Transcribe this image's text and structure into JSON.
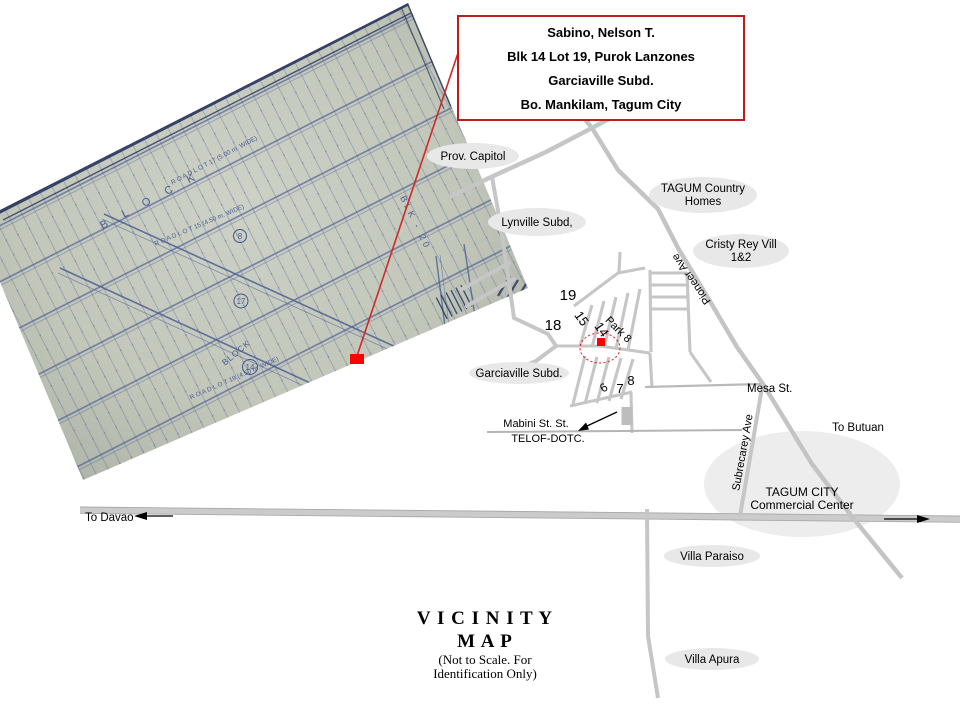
{
  "info_box": {
    "line1": "Sabino, Nelson T.",
    "line2": "Blk  14 Lot 19, Purok Lanzones",
    "line3": "Garciaville Subd.",
    "line4": "Bo. Mankilam, Tagum City"
  },
  "title_block": {
    "line1": "V I C I N I T Y",
    "line2": "M A P",
    "note1": "(Not to Scale. For",
    "note2": "Identification Only)"
  },
  "labels": {
    "prov_capitol": "Prov. Capitol",
    "lynville": "Lynville Subd,",
    "tagum_country_line1": "TAGUM Country",
    "tagum_country_line2": "Homes",
    "cristy_line1": "Cristy Rey Vill",
    "cristy_line2": "1&2",
    "garciaville": "Garciaville Subd.",
    "mesa_st": "Mesa St.",
    "to_butuan": "To Butuan",
    "to_davao": "To Davao",
    "mabini_st": "Mabini St. St.",
    "telof_dotc": "TELOF-DOTC.",
    "commercial_line1": "TAGUM CITY",
    "commercial_line2": "Commercial Center",
    "villa_paraiso": "Villa Paraiso",
    "villa_apura": "Villa Apura",
    "pioneer_ave": "Pioneer Ave",
    "subrecarey_ave": "Subrecarey Ave"
  },
  "numbers": {
    "n19": "19",
    "n18": "18",
    "n15": "15",
    "n14": "14",
    "park8": "Park 8",
    "n8": "8",
    "n7": "7",
    "n6": "6"
  },
  "blueprint": {
    "lot_title": "LOT 495-A-3 (LRC) Psd-217103",
    "road_lot_17": "R O A D   L O T   17   (5.00 m. WIDE)",
    "road_lot_15": "R O A D   L O T   15   (4.50 m. WIDE)",
    "road_lot_19": "R O A D   L O T   19   (4.50 m. WIDE)",
    "block_word": "B L O C K",
    "block_label": "BLOCK",
    "circle_14": "14",
    "circle_17": "17",
    "circle_8": "8",
    "blk_20": "BLK - 20"
  },
  "colors": {
    "callout_red": "#e01010",
    "road_gray": "#c6c6c6",
    "label_ellipse_gray": "#e8e8e8",
    "paper_gray_green": "#c3c7bb",
    "blueprint_ink": "#41538f",
    "navy_edge": "#26335c"
  }
}
